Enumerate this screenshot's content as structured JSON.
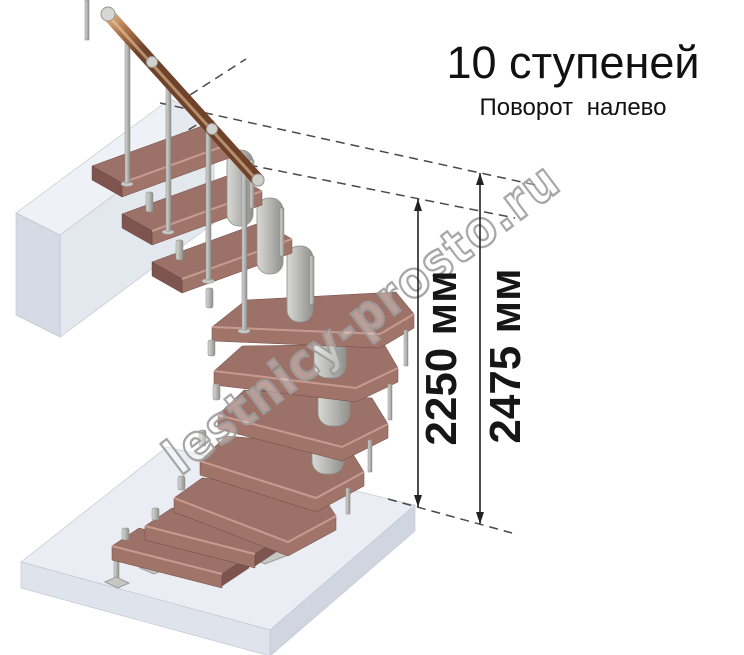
{
  "annotation": {
    "title": "10 ступеней",
    "subtitle": "Поворот налево"
  },
  "dimensions": [
    {
      "label": "2250 мм",
      "value_mm": 2250
    },
    {
      "label": "2475 мм",
      "value_mm": 2475
    }
  ],
  "watermark": {
    "text": "lestnicy-prosto.ru"
  },
  "staircase": {
    "steps_count": 10,
    "turn_direction": "налево",
    "style": "modular open staircase with winder treads, central spine columns, wooden handrail"
  },
  "colors": {
    "background": "#ffffff",
    "tread_top": "#9c7168",
    "tread_front": "#a1746a",
    "tread_side": "#7e554e",
    "tread_highlight": "#cda195",
    "metal_light": "#d8d8d5",
    "metal_dark": "#8f8f8b",
    "handrail_light": "#e8c49b",
    "handrail_dark": "#6f4229",
    "floor_top": "#eef1f6",
    "floor_shadowed": "#d5dae4",
    "dimension_line": "#222222",
    "text": "#111111",
    "watermark_outline": "#9e9e9e"
  }
}
